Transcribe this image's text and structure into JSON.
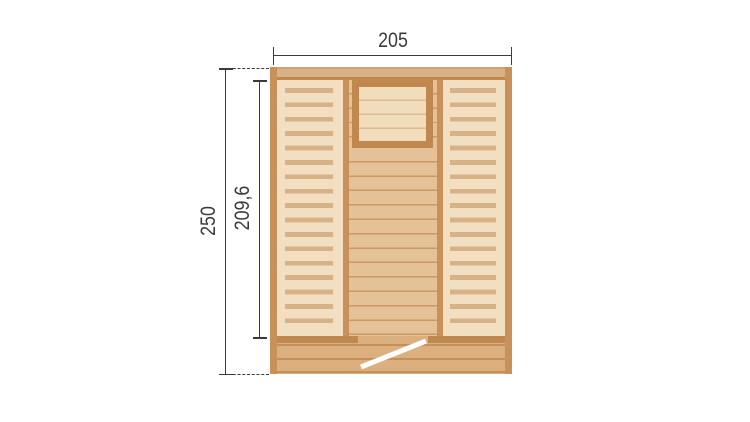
{
  "dimensions": {
    "width_label": "205",
    "total_height_label": "250",
    "wall_height_label": "209,6"
  },
  "colors": {
    "dim": "#3b3b3b",
    "bar_tan": "#d8b185",
    "bar_top": "#cfa173",
    "dark_wood": "#c0884e",
    "stile": "#c8915a",
    "louver_bg": "#f2dfc1",
    "slat": "#d8b287",
    "center_bg": "#e4c196",
    "plank_line": "#c99a66",
    "window_bg": "#f1dcbc",
    "window_line": "#ddba90",
    "bottom_bg": "#dcb07e",
    "bottom_line": "#c3905c",
    "swing": "#ffffff",
    "page_bg": "#ffffff"
  }
}
